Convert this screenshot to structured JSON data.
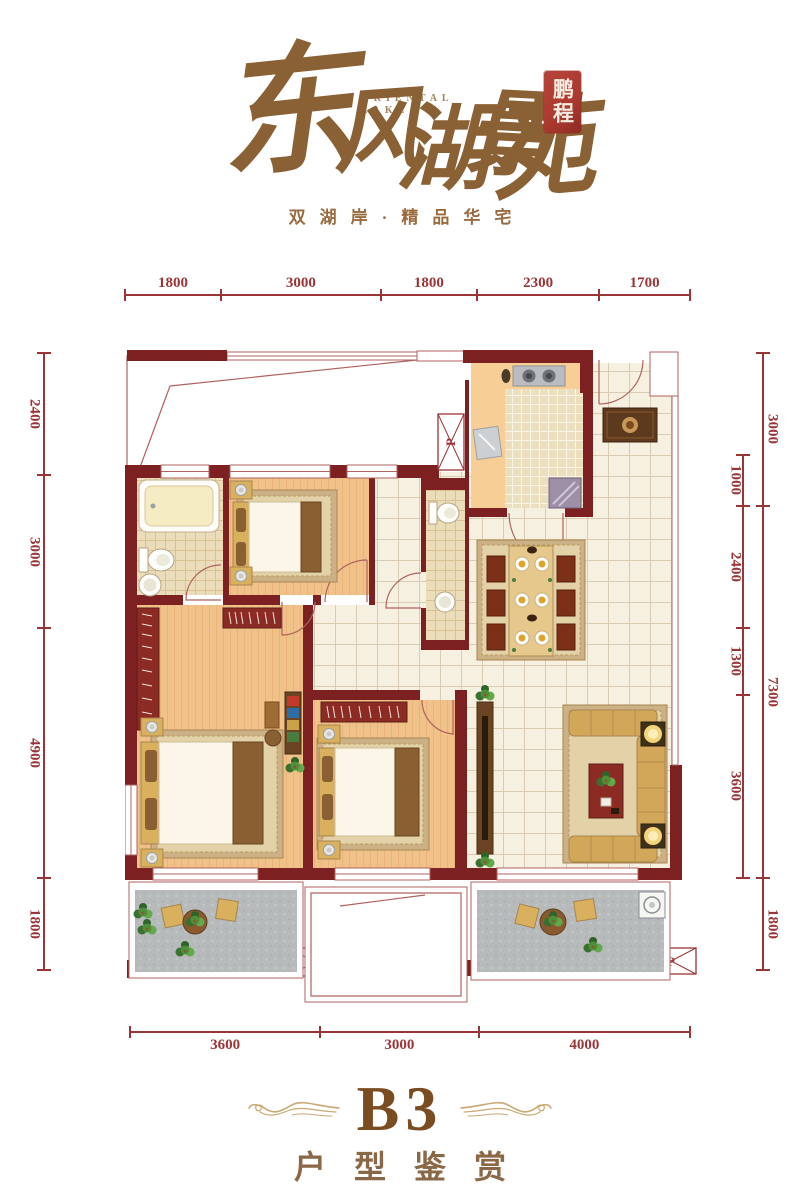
{
  "header": {
    "title": "东风湖景苑",
    "title_chars": [
      "东",
      "风",
      "湖",
      "景",
      "苑"
    ],
    "title_en": [
      "ORIENTAL",
      "LAKE"
    ],
    "seal": "鹏程",
    "tagline": "双湖岸·精品华宅"
  },
  "dimensions": {
    "top": [
      "1800",
      "3000",
      "1800",
      "2300",
      "1700"
    ],
    "left": [
      "2400",
      "3000",
      "4900",
      "1800"
    ],
    "right_inner": [
      "1000",
      "2400",
      "1300",
      "3600"
    ],
    "right_outer": [
      "3000",
      "7300",
      "1800"
    ],
    "bottom": [
      "3600",
      "3000",
      "4000"
    ]
  },
  "plan": {
    "shafts": [
      "P",
      "P",
      "P"
    ]
  },
  "footer": {
    "unit": "B3",
    "caption": "户型鉴赏"
  },
  "colors": {
    "brand": "#8a6134",
    "tagline": "#9a6b3f",
    "seal": "#ad3a30",
    "dim": "#9b3436",
    "wall": "#7d2022",
    "footer": "#7a4c22"
  }
}
